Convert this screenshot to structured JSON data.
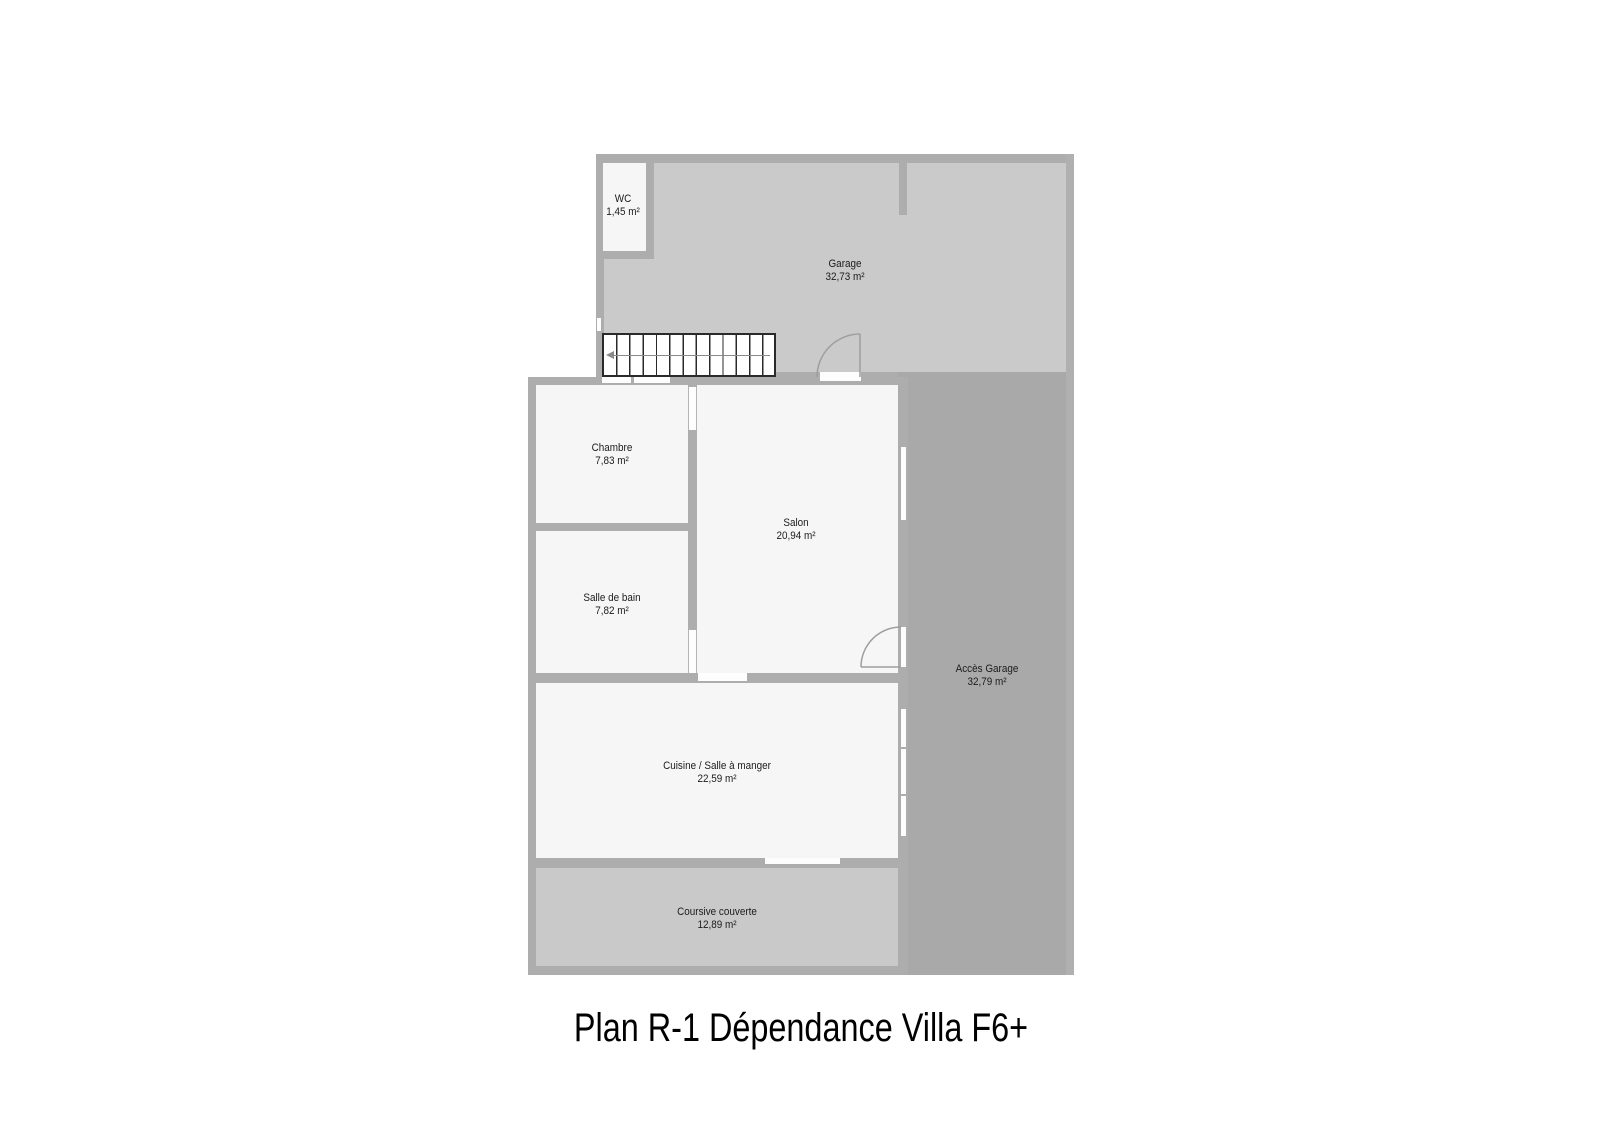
{
  "title": "Plan R-1 Dépendance Villa F6+",
  "rooms": [
    {
      "name": "WC",
      "area": "1,45 m²"
    },
    {
      "name": "Garage",
      "area": "32,73 m²"
    },
    {
      "name": "Chambre",
      "area": "7,83 m²"
    },
    {
      "name": "Salon",
      "area": "20,94 m²"
    },
    {
      "name": "Salle de bain",
      "area": "7,82 m²"
    },
    {
      "name": "Accès Garage",
      "area": "32,79 m²"
    },
    {
      "name": "Cuisine / Salle à manger",
      "area": "22,59 m²"
    },
    {
      "name": "Coursive couverte",
      "area": "12,89 m²"
    }
  ],
  "colors": {
    "background": "#ffffff",
    "wall": "#adadad",
    "garage_floor": "#cacaca",
    "coursive_floor": "#c9c9c9",
    "acces_floor": "#a9a9a9",
    "room": "#f6f6f6",
    "stairs_line": "#2a2a2a",
    "door_stroke": "#9e9e9e",
    "label_text": "#1b1b1b"
  }
}
